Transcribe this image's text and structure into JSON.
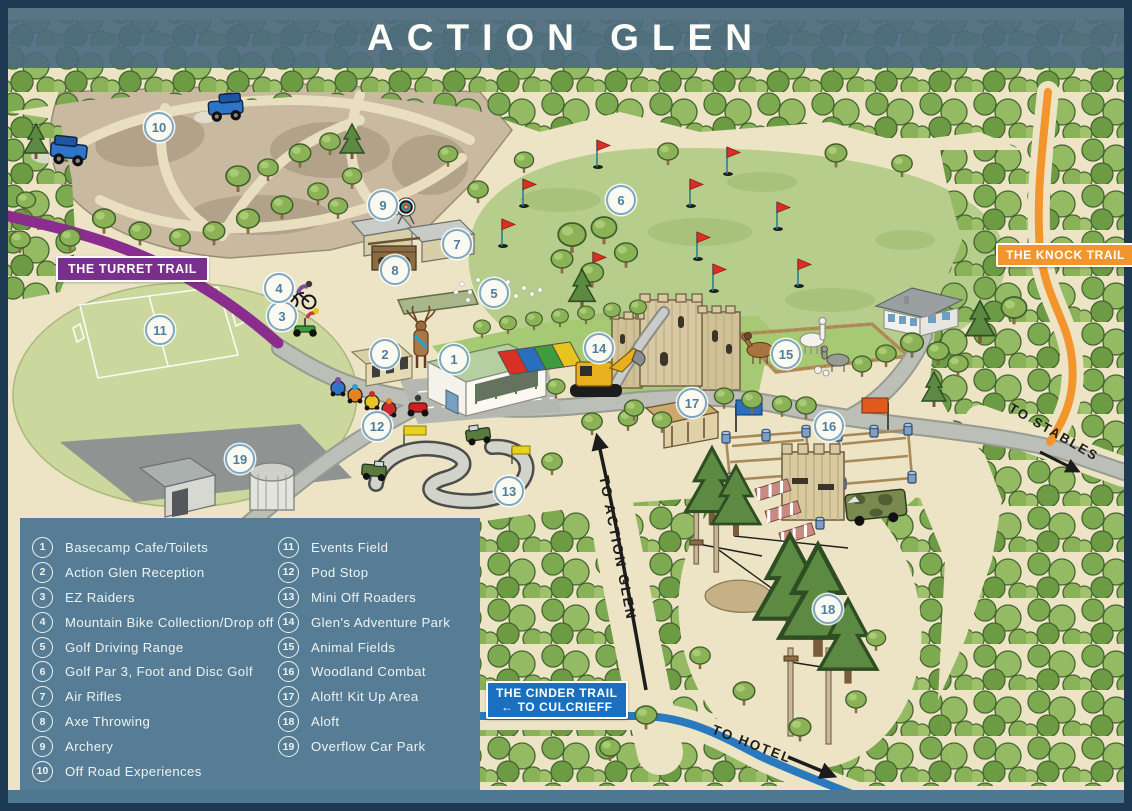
{
  "title": "ACTION GLEN",
  "legend": {
    "items": [
      {
        "number": "1",
        "label": "Basecamp Cafe/Toilets"
      },
      {
        "number": "2",
        "label": "Action Glen Reception"
      },
      {
        "number": "3",
        "label": "EZ Raiders"
      },
      {
        "number": "4",
        "label": "Mountain Bike Collection/Drop off"
      },
      {
        "number": "5",
        "label": "Golf Driving Range"
      },
      {
        "number": "6",
        "label": "Golf Par 3, Foot and Disc Golf"
      },
      {
        "number": "7",
        "label": "Air Rifles"
      },
      {
        "number": "8",
        "label": "Axe Throwing"
      },
      {
        "number": "9",
        "label": "Archery"
      },
      {
        "number": "10",
        "label": "Off Road Experiences"
      },
      {
        "number": "11",
        "label": "Events Field"
      },
      {
        "number": "12",
        "label": "Pod Stop"
      },
      {
        "number": "13",
        "label": "Mini Off Roaders"
      },
      {
        "number": "14",
        "label": "Glen's Adventure Park"
      },
      {
        "number": "15",
        "label": "Animal Fields"
      },
      {
        "number": "16",
        "label": "Woodland Combat"
      },
      {
        "number": "17",
        "label": "Aloft! Kit Up Area"
      },
      {
        "number": "18",
        "label": "Aloft"
      },
      {
        "number": "19",
        "label": "Overflow Car Park"
      }
    ]
  },
  "map": {
    "markers": [
      {
        "number": "1",
        "x": 452,
        "y": 357
      },
      {
        "number": "2",
        "x": 383,
        "y": 352
      },
      {
        "number": "3",
        "x": 280,
        "y": 314
      },
      {
        "number": "4",
        "x": 277,
        "y": 286
      },
      {
        "number": "5",
        "x": 492,
        "y": 291
      },
      {
        "number": "6",
        "x": 619,
        "y": 198
      },
      {
        "number": "7",
        "x": 455,
        "y": 242
      },
      {
        "number": "8",
        "x": 393,
        "y": 268
      },
      {
        "number": "9",
        "x": 381,
        "y": 203
      },
      {
        "number": "10",
        "x": 157,
        "y": 125
      },
      {
        "number": "11",
        "x": 158,
        "y": 328
      },
      {
        "number": "12",
        "x": 375,
        "y": 424
      },
      {
        "number": "13",
        "x": 507,
        "y": 489
      },
      {
        "number": "14",
        "x": 597,
        "y": 346
      },
      {
        "number": "15",
        "x": 784,
        "y": 352
      },
      {
        "number": "16",
        "x": 827,
        "y": 424
      },
      {
        "number": "17",
        "x": 690,
        "y": 401
      },
      {
        "number": "18",
        "x": 826,
        "y": 607
      },
      {
        "number": "19",
        "x": 238,
        "y": 457
      }
    ],
    "trail_badges": {
      "turret": {
        "label": "THE TURRET TRAIL",
        "color": "#7b2f8c"
      },
      "knock": {
        "label": "THE KNOCK TRAIL",
        "color": "#f2952d"
      },
      "cinder": {
        "line1": "THE CINDER TRAIL",
        "line2": "← TO CULCRIEFF",
        "color": "#1a70bf"
      }
    },
    "direction_labels": {
      "stables": "TO STABLES",
      "action_glen": "TO ACTION GLEN",
      "hotel": "TO HOTEL"
    },
    "colors": {
      "turret_trail": "#8a2d8f",
      "knock_trail": "#f2952d",
      "cinder_trail": "#2979bf",
      "legend_panel": "#567d95",
      "frame": "#1d3a52",
      "banner": "#4b6a7f"
    }
  }
}
